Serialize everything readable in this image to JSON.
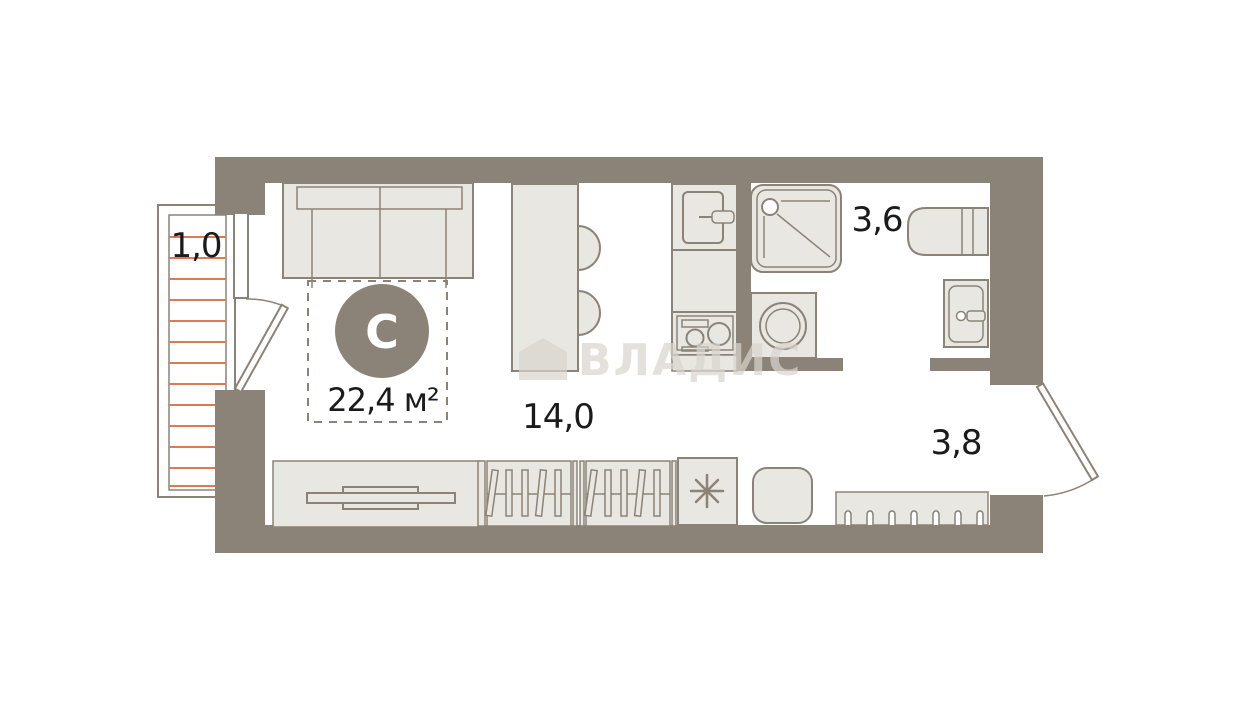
{
  "floor_plan": {
    "compass": "С",
    "total_area": "22,4 м²",
    "areas": {
      "balcony": "1,0",
      "living_kitchen": "14,0",
      "bathroom": "3,6",
      "hallway": "3,8"
    },
    "watermark": "ВЛАДИС",
    "colors": {
      "wall": "#8b8377",
      "outline": "#8b8377",
      "furniture_fill": "#e9e7e2",
      "balcony_hatch": "#dc7b53",
      "label_text": "#1b1b1b",
      "compass_text": "#ffffff",
      "watermark": "#d9d5cf",
      "background": "#ffffff"
    }
  }
}
